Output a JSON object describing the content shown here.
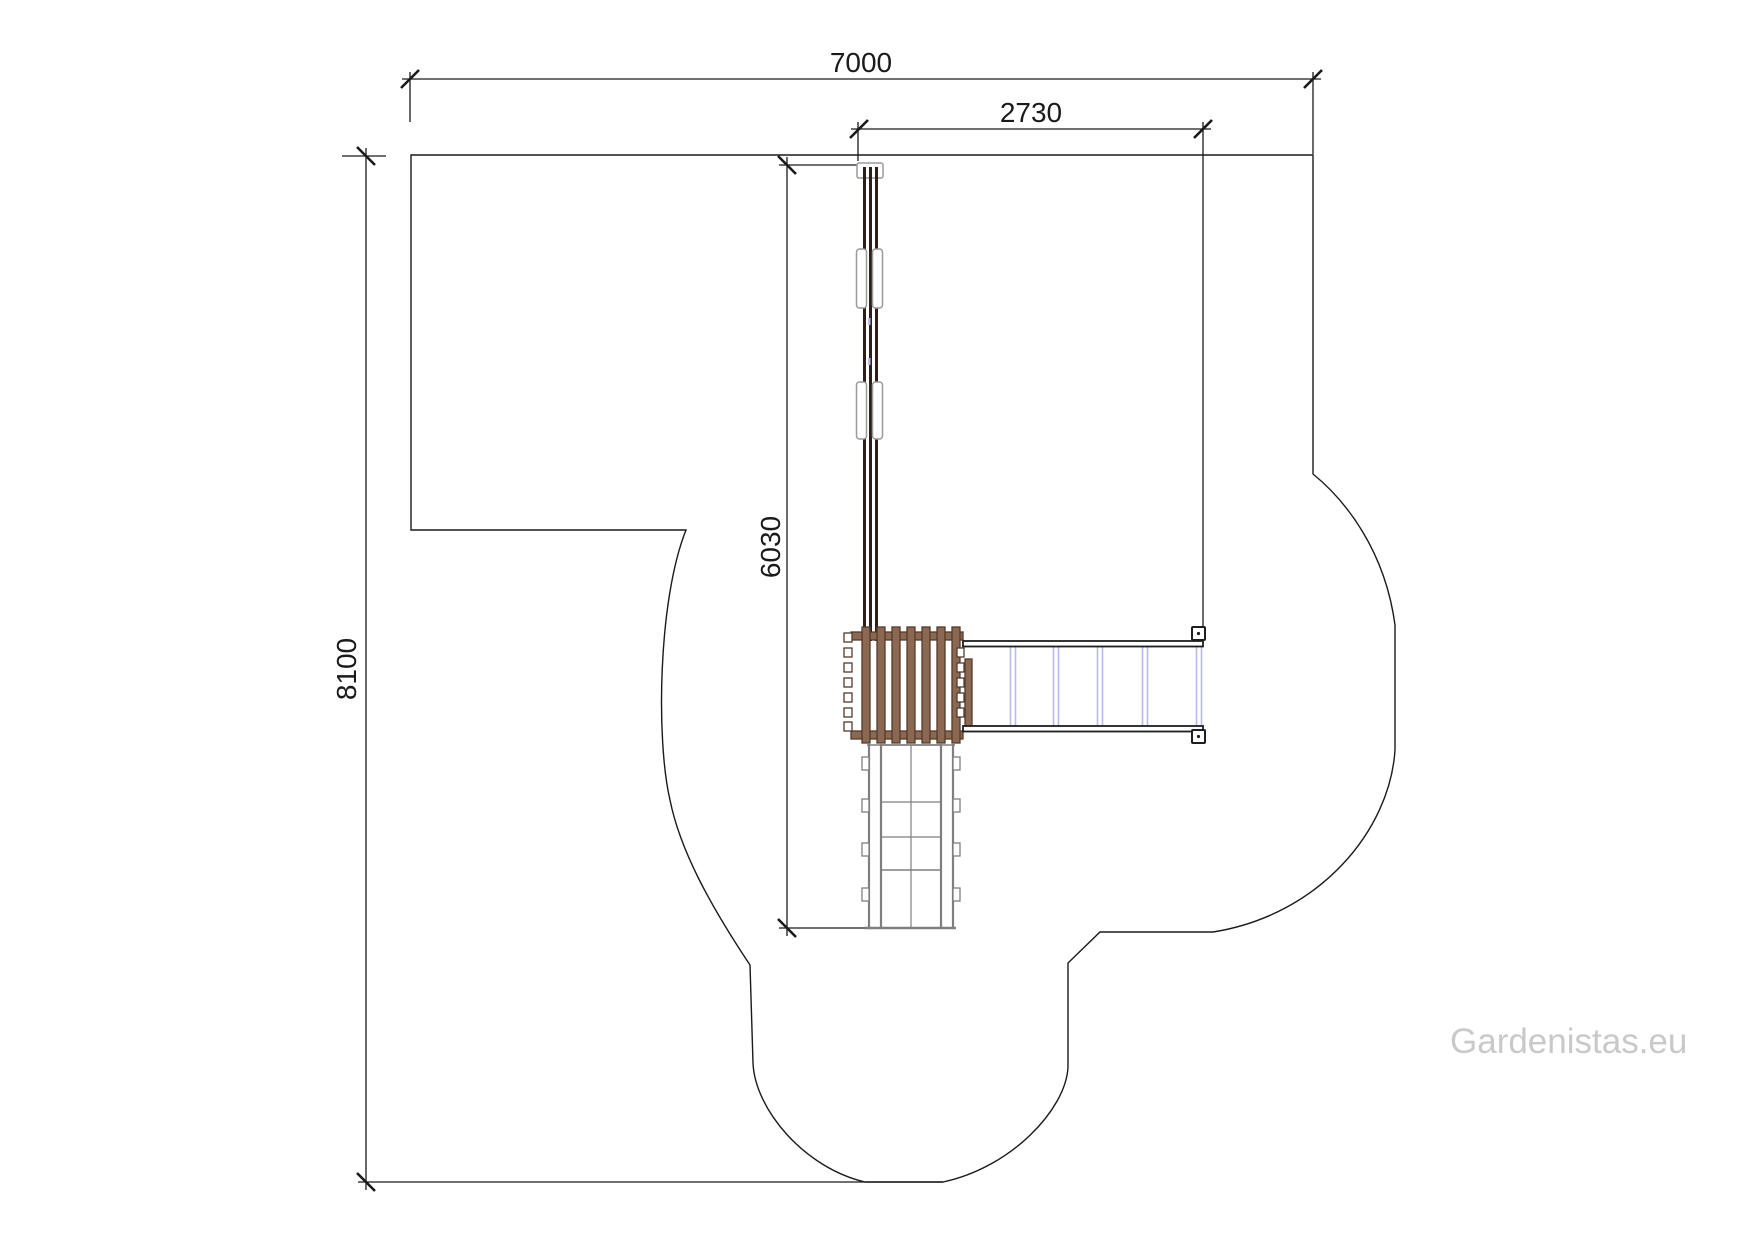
{
  "dimensions": {
    "total_width_mm": "7000",
    "upper_width_mm": "2730",
    "structure_length_mm": "6030",
    "total_height_mm": "8100"
  },
  "watermark": "Gardenistas.eu",
  "colors": {
    "background": "#ffffff",
    "line": "#1a1a1a",
    "dimension_text": "#1a1a1a",
    "slide_rail_dark": "#2e1e18",
    "wood_fill": "#8a6852",
    "wood_outline": "#553a2a",
    "ladder_gray": "#7f7f7f",
    "sleeve_gray": "#9a9a9a",
    "bridge_dark": "#1f1f1f",
    "bridge_rung_blue": "#b6baec",
    "watermark_gray": "#c9c9c9"
  }
}
